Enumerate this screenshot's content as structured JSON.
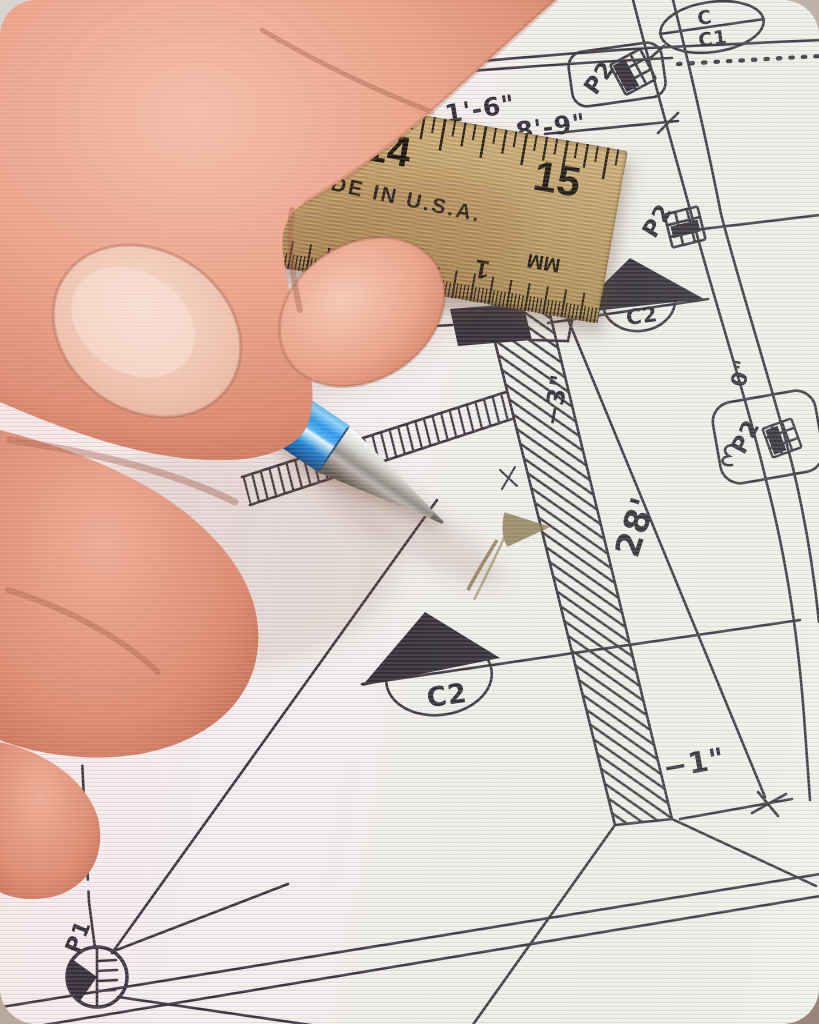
{
  "photo": {
    "description": "Close-up photograph of a hand holding a blue mechanical pencil over an engineering site plan drawing, with a wooden ruler lying on the paper"
  },
  "ruler": {
    "inch_14": "14",
    "inch_15": "15",
    "made_in": "MADE IN U.S.A.",
    "back_2": "2",
    "back_1": "1",
    "unit_mm": "MM"
  },
  "plan": {
    "dim_top_left": "1'-6\"",
    "dim_top_right": "8'-9\"",
    "length_28": "28'",
    "offset_zero": "0\"",
    "offset_minus3": "−3\"",
    "offset_minus1": "−1\"",
    "callout_c": {
      "top": "C",
      "bottom": "C1"
    },
    "callout_j": {
      "top": "J",
      "bottom": "C2"
    },
    "callout_k": {
      "top": "K",
      "bottom": "C2"
    },
    "label_p2_top": "P2",
    "label_p2_mid": "P2",
    "label_p2_right": "P2",
    "label_p1": "P1"
  },
  "colors": {
    "pencil_blue": "#2a97e6",
    "ruler_wood": "#b3915b",
    "ink": "#38333d",
    "paper": "#f3efee",
    "skin": "#eba186",
    "graphite_arrow": "#8a7950"
  }
}
